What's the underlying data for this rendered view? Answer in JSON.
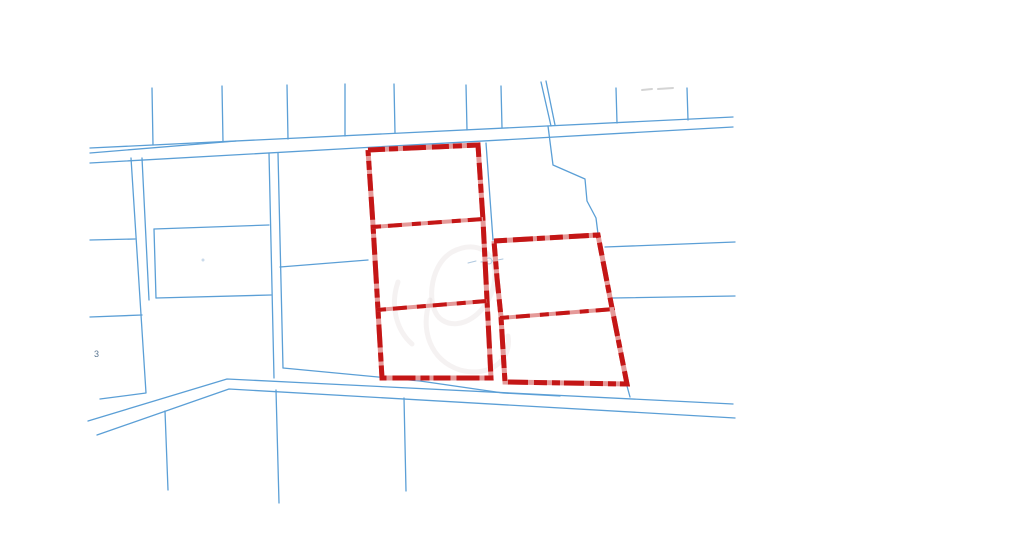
{
  "map": {
    "width": 1024,
    "height": 549,
    "background": "#ffffff",
    "colors": {
      "parcel_line": "#5b9fd6",
      "selection_red": "#c41616",
      "selection_pink": "#e59a99",
      "watermark": "#c4b2b2",
      "faint_blue": "#a6c2dc",
      "faint_gray": "#c9c9c9",
      "label_text": "#3f5f7f"
    },
    "blue_line_width": 1.3,
    "red_line_width": 5,
    "blue_lines": [
      {
        "name": "top-road-upper-edge",
        "points": [
          [
            90,
            148
          ],
          [
            733,
            117
          ]
        ]
      },
      {
        "name": "top-road-lower-edge",
        "points": [
          [
            90,
            163
          ],
          [
            733,
            127
          ]
        ]
      },
      {
        "name": "top-road-inner-edge",
        "points": [
          [
            90,
            153
          ],
          [
            236,
            141
          ]
        ]
      },
      {
        "name": "north-lot-line-1",
        "points": [
          [
            152,
            88
          ],
          [
            153,
            145
          ]
        ]
      },
      {
        "name": "north-lot-line-2",
        "points": [
          [
            222,
            86
          ],
          [
            223,
            142
          ]
        ]
      },
      {
        "name": "north-lot-line-3",
        "points": [
          [
            287,
            85
          ],
          [
            288,
            139
          ]
        ]
      },
      {
        "name": "north-lot-line-4",
        "points": [
          [
            345,
            84
          ],
          [
            345,
            136
          ]
        ]
      },
      {
        "name": "north-lot-line-5",
        "points": [
          [
            394,
            84
          ],
          [
            395,
            133
          ]
        ]
      },
      {
        "name": "north-lot-line-6",
        "points": [
          [
            466,
            85
          ],
          [
            467,
            130
          ]
        ]
      },
      {
        "name": "north-lot-line-7",
        "points": [
          [
            501,
            86
          ],
          [
            502,
            128
          ]
        ]
      },
      {
        "name": "north-lot-line-8a",
        "points": [
          [
            541,
            82
          ],
          [
            551,
            126
          ]
        ]
      },
      {
        "name": "north-lot-line-8b",
        "points": [
          [
            546,
            81
          ],
          [
            555,
            125
          ]
        ]
      },
      {
        "name": "north-lot-line-9",
        "points": [
          [
            616,
            88
          ],
          [
            617,
            123
          ]
        ]
      },
      {
        "name": "north-lot-line-10",
        "points": [
          [
            687,
            88
          ],
          [
            688,
            120
          ]
        ]
      },
      {
        "name": "stepped-boundary",
        "points": [
          [
            548,
            126
          ],
          [
            553,
            165
          ],
          [
            585,
            179
          ],
          [
            587,
            201
          ],
          [
            596,
            218
          ],
          [
            598,
            234
          ]
        ]
      },
      {
        "name": "mid-vertical-boundary",
        "points": [
          [
            486,
            143
          ],
          [
            493,
            240
          ]
        ]
      },
      {
        "name": "east-parcel-line-upper",
        "points": [
          [
            605,
            247
          ],
          [
            735,
            242
          ]
        ]
      },
      {
        "name": "east-parcel-line-lower",
        "points": [
          [
            613,
            298
          ],
          [
            735,
            296
          ]
        ]
      },
      {
        "name": "west-lane-edge-left",
        "points": [
          [
            269,
            153
          ],
          [
            274,
            378
          ]
        ]
      },
      {
        "name": "west-lane-edge-right",
        "points": [
          [
            278,
            153
          ],
          [
            283,
            368
          ]
        ]
      },
      {
        "name": "west-diagonal-connector",
        "points": [
          [
            280,
            267
          ],
          [
            368,
            260
          ]
        ]
      },
      {
        "name": "left-boundary-with-corner",
        "points": [
          [
            131,
            158
          ],
          [
            146,
            393
          ],
          [
            100,
            399
          ]
        ]
      },
      {
        "name": "left-boundary-pair",
        "points": [
          [
            142,
            158
          ],
          [
            149,
            300
          ]
        ]
      },
      {
        "name": "left-edge-spur-1",
        "points": [
          [
            90,
            240
          ],
          [
            135,
            239
          ]
        ]
      },
      {
        "name": "left-edge-spur-2",
        "points": [
          [
            90,
            317
          ],
          [
            142,
            315
          ]
        ]
      },
      {
        "name": "mid-parcel-box-top",
        "points": [
          [
            154,
            229
          ],
          [
            269,
            225
          ]
        ]
      },
      {
        "name": "mid-parcel-box-left",
        "points": [
          [
            154,
            229
          ],
          [
            156,
            298
          ]
        ]
      },
      {
        "name": "mid-parcel-box-bottom",
        "points": [
          [
            156,
            298
          ],
          [
            271,
            295
          ]
        ]
      },
      {
        "name": "bottom-road-upper-edge",
        "points": [
          [
            88,
            421
          ],
          [
            227,
            379
          ],
          [
            733,
            404
          ]
        ]
      },
      {
        "name": "bottom-road-lower-edge",
        "points": [
          [
            97,
            435
          ],
          [
            229,
            389
          ],
          [
            735,
            418
          ]
        ]
      },
      {
        "name": "bottom-frontage-line",
        "points": [
          [
            283,
            368
          ],
          [
            420,
            381
          ],
          [
            503,
            393
          ],
          [
            560,
            396
          ]
        ]
      },
      {
        "name": "frontage-corner-stub",
        "points": [
          [
            627,
            386
          ],
          [
            630,
            397
          ]
        ]
      },
      {
        "name": "south-lot-line-1",
        "points": [
          [
            165,
            411
          ],
          [
            168,
            490
          ]
        ]
      },
      {
        "name": "south-lot-line-2",
        "points": [
          [
            276,
            390
          ],
          [
            279,
            503
          ]
        ]
      },
      {
        "name": "south-lot-line-3",
        "points": [
          [
            404,
            398
          ],
          [
            406,
            491
          ]
        ]
      }
    ],
    "red_groups": [
      {
        "name": "selected-parcels-west",
        "outline": [
          [
            368,
            150
          ],
          [
            478,
            145
          ],
          [
            483,
            220
          ],
          [
            487,
            300
          ],
          [
            491,
            378
          ],
          [
            382,
            378
          ],
          [
            378,
            310
          ],
          [
            373,
            225
          ],
          [
            368,
            150
          ]
        ],
        "dividers": [
          [
            [
              372,
              227
            ],
            [
              483,
              219
            ]
          ],
          [
            [
              377,
              310
            ],
            [
              487,
              301
            ]
          ]
        ]
      },
      {
        "name": "selected-parcels-east",
        "outline": [
          [
            494,
            241
          ],
          [
            598,
            235
          ],
          [
            612,
            308
          ],
          [
            627,
            384
          ],
          [
            505,
            382
          ],
          [
            501,
            317
          ],
          [
            497,
            278
          ],
          [
            494,
            241
          ]
        ],
        "dividers": [
          [
            [
              500,
              318
            ],
            [
              614,
              309
            ]
          ]
        ]
      }
    ],
    "watermark_paths": [
      "M452,252 C478,238 500,254 494,284 C488,314 460,332 442,320 C426,310 428,266 452,252",
      "M430,300 C420,330 430,360 460,370 C490,378 512,360 508,336",
      "M398,282 C390,305 396,330 412,344"
    ],
    "faint_marks": {
      "tiny_survey_mark": "M468,263 l8,-2 m5,1 l7,-1 m4,0 l11,-2",
      "tiny_survey_circle": {
        "cx": 489,
        "cy": 261,
        "r": 3
      },
      "top_gray_dashes": "M642,90 l10,-1 m6,0 l15,-1",
      "small_dot": {
        "cx": 203,
        "cy": 260,
        "r": 1.5
      }
    },
    "labels": [
      {
        "name": "parcel-number-label",
        "text": "3",
        "x": 94,
        "y": 357,
        "size": 9
      }
    ]
  }
}
